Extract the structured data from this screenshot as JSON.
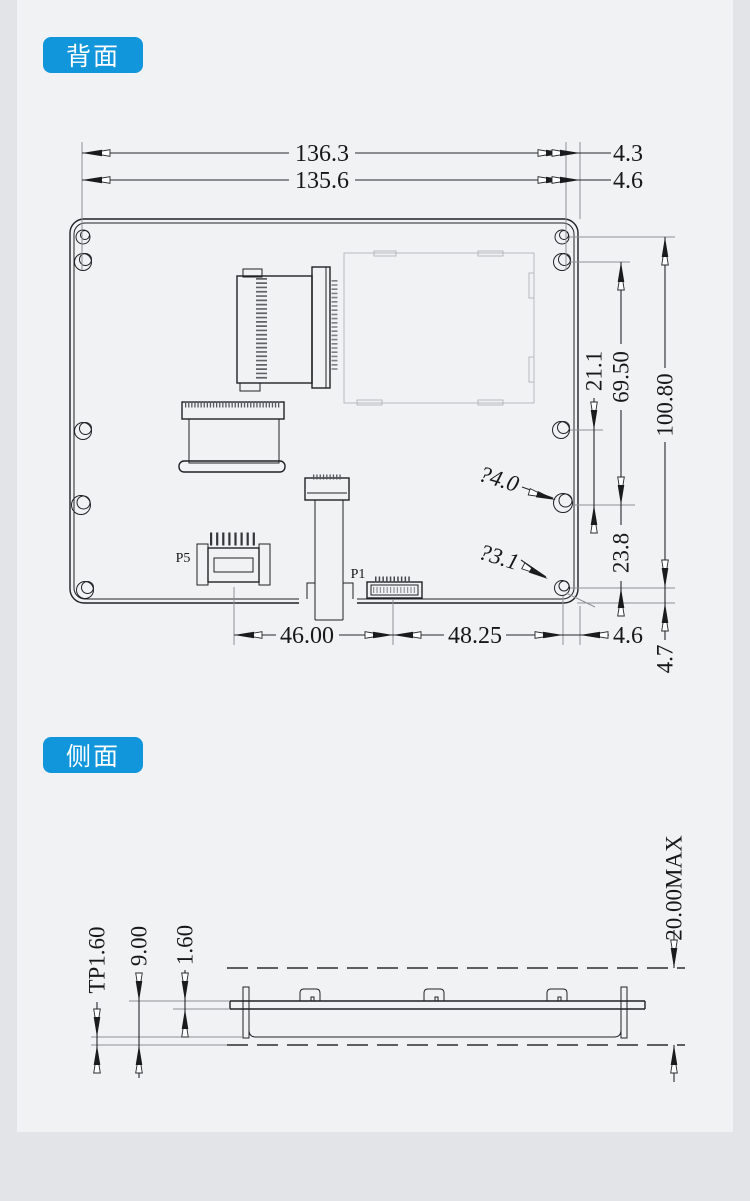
{
  "labels": {
    "back_badge": "背面",
    "side_badge": "侧面"
  },
  "colors": {
    "accent": "#1296db"
  },
  "back_view": {
    "connectors": {
      "p5": "P5",
      "p1": "P1"
    },
    "dims": {
      "total_width": "136.3",
      "right_offset_top": "4.3",
      "board_width": "135.6",
      "right_offset": "4.6",
      "hole_gap": "21.1",
      "hole_span_mid": "69.50",
      "hole_span_full": "100.80",
      "hole_dia_large": "?4.0",
      "hole_dia_small": "?3.1",
      "hole_gap_lower": "23.8",
      "p5_to_p1": "46.00",
      "p1_to_edge": "48.25",
      "bottom_right_offset": "4.6",
      "bottom_edge_offset": "4.7"
    }
  },
  "side_view": {
    "dims": {
      "tp_thickness": "TP1.60",
      "module_thickness": "9.00",
      "panel_thickness": "1.60",
      "max_thickness": "20.00MAX"
    }
  }
}
